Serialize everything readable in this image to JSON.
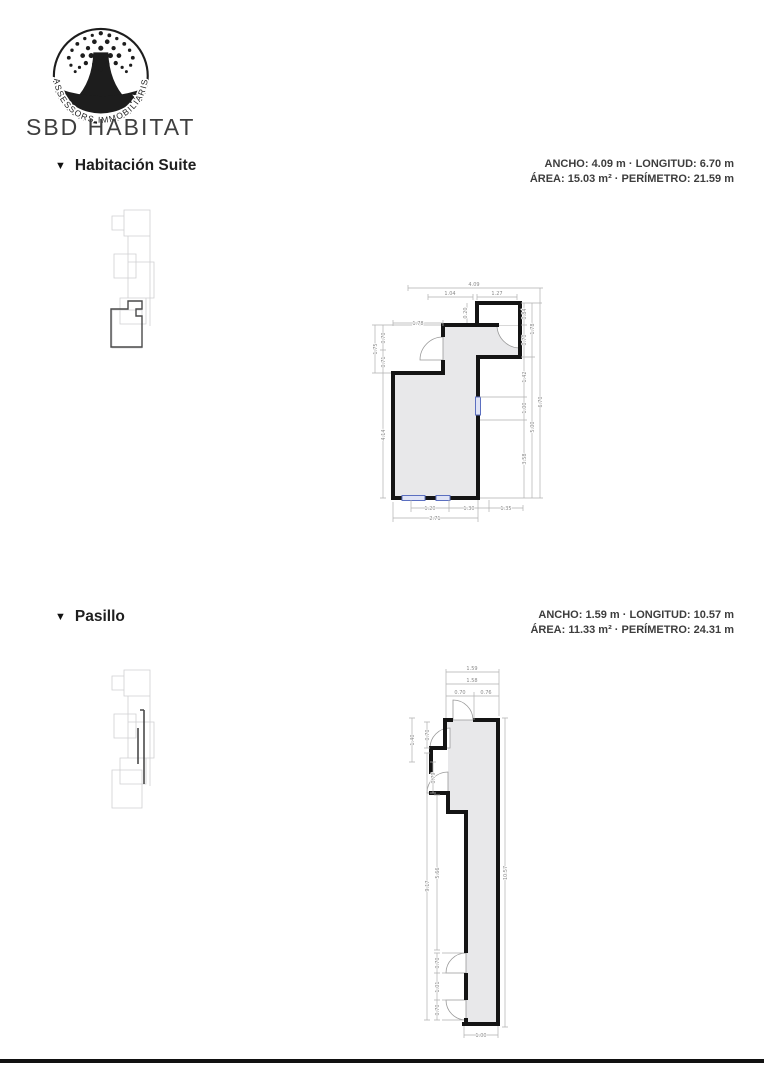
{
  "logo": {
    "arc_text": "ASSESSORS IMMOBILIARIS",
    "brand": "SBD HABITAT"
  },
  "sections": [
    {
      "marker": "▼",
      "title": "Habitación Suite",
      "stats_line1": "ANCHO: 4.09 m · LONGITUD: 6.70 m",
      "stats_line2": "ÁREA: 15.03 m² · PERÍMETRO: 21.59 m",
      "plan": {
        "dims": [
          "4.09",
          "1.04",
          "1.27",
          "1.78",
          "0.20",
          "1.75",
          "0.70",
          "0.71",
          "4.14",
          "0.84",
          "0.70",
          "1.42",
          "1.00",
          "3.58",
          "1.78",
          "5.00",
          "6.70",
          "1.20",
          "1.30",
          "1.35",
          "2.71"
        ]
      }
    },
    {
      "marker": "▼",
      "title": "Pasillo",
      "stats_line1": "ANCHO: 1.59 m · LONGITUD: 10.57 m",
      "stats_line2": "ÁREA: 11.33 m² · PERÍMETRO: 24.31 m",
      "plan": {
        "dims": [
          "1.59",
          "1.58",
          "0.70",
          "0.76",
          "1.40",
          "0.70",
          "0.79",
          "9.17",
          "5.66",
          "0.70",
          "1.01",
          "0.70",
          "10.57",
          "1.00"
        ]
      }
    }
  ],
  "colors": {
    "wall": "#141414",
    "room_fill": "#e8e8ea",
    "dimension": "#9a9a9a",
    "window_stroke": "#5b6fc0",
    "window_fill": "#dfe3f5",
    "minimap": "#cfcfd2",
    "minimap_highlight": "#4a4a4a"
  }
}
